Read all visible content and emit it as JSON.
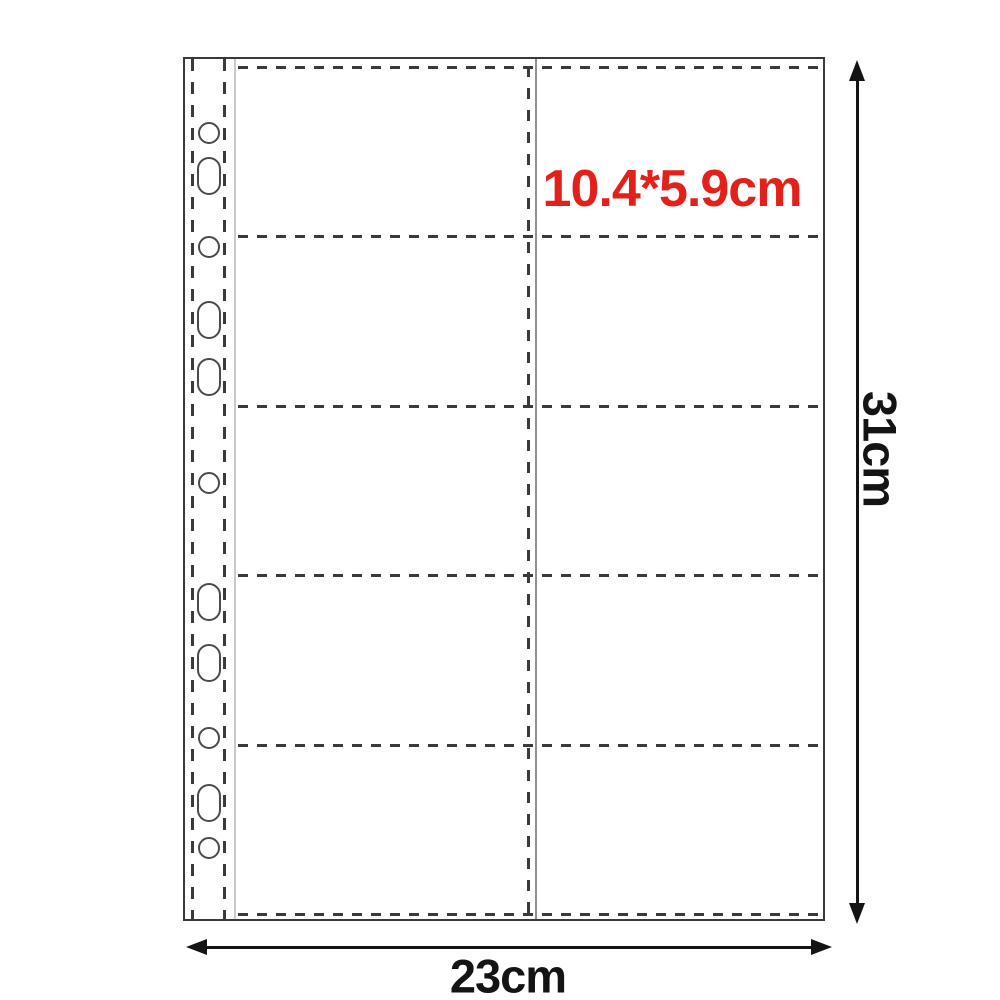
{
  "diagram": {
    "type": "product-dimension-diagram",
    "labels": {
      "pocket_size": "10.4*5.9cm",
      "page_height": "31cm",
      "page_width": "23cm"
    },
    "grid": {
      "rows": 5,
      "columns": 2,
      "pockets": 10
    },
    "row_line_y": [
      7,
      176,
      346,
      515,
      685,
      854
    ],
    "holes": [
      {
        "shape": "circle",
        "cy": 74
      },
      {
        "shape": "oblong",
        "cy": 117
      },
      {
        "shape": "circle",
        "cy": 188
      },
      {
        "shape": "oblong",
        "cy": 261
      },
      {
        "shape": "oblong",
        "cy": 318
      },
      {
        "shape": "circle",
        "cy": 424
      },
      {
        "shape": "oblong",
        "cy": 543
      },
      {
        "shape": "oblong",
        "cy": 604
      },
      {
        "shape": "circle",
        "cy": 679
      },
      {
        "shape": "oblong",
        "cy": 744
      },
      {
        "shape": "circle",
        "cy": 789
      }
    ],
    "colors": {
      "pocket_size_text": "#e3211a",
      "dimension_text": "#141414",
      "arrow": "#141414",
      "line": "#3a3a3a",
      "seam": "#909090",
      "strip_edge": "#c8c8c8"
    }
  }
}
